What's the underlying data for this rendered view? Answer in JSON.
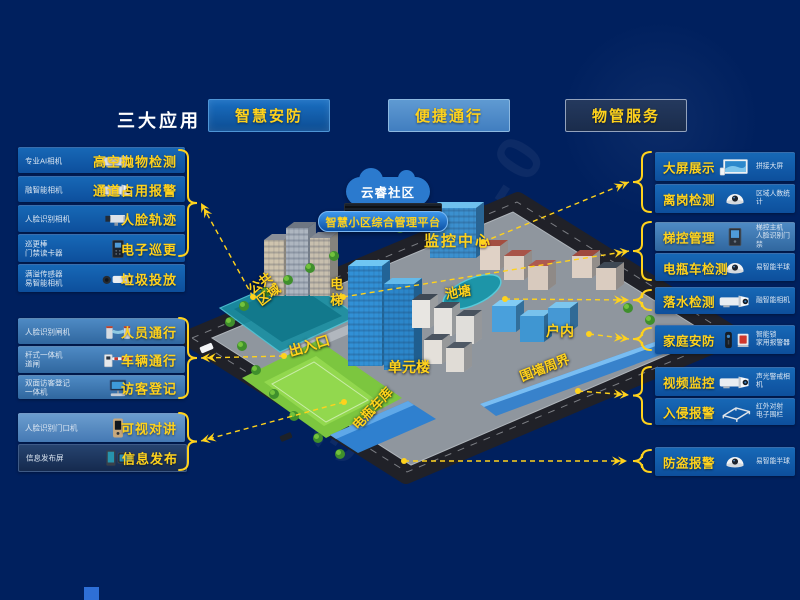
{
  "header": {
    "title": "三大应用",
    "apps": [
      {
        "label": "智慧安防"
      },
      {
        "label": "便捷通行"
      },
      {
        "label": "物管服务"
      }
    ]
  },
  "platform": {
    "cloud_label": "云睿社区",
    "banner": "智慧小区综合管理平台",
    "monitor_center": "监控中心"
  },
  "left_groups": [
    {
      "items": [
        {
          "device": "专业AI相机",
          "label": "高空抛物检测",
          "icon": "bullet-camera-icon"
        },
        {
          "device": "融智能相机",
          "label": "通道占用报警",
          "icon": "bullet-camera-icon"
        },
        {
          "device": "人脸识别相机",
          "label": "人脸轨迹",
          "icon": "box-camera-icon"
        },
        {
          "device": "巡更棒\n门禁读卡器",
          "label": "电子巡更",
          "icon": "access-reader-icon"
        },
        {
          "device": "满溢传感器\n易智能相机",
          "label": "垃圾投放",
          "icon": "sensor-camera-icon"
        }
      ]
    },
    {
      "items": [
        {
          "device": "人脸识别闸机",
          "label": "人员通行",
          "icon": "turnstile-icon"
        },
        {
          "device": "杆式一体机\n道闸",
          "label": "车辆通行",
          "icon": "barrier-gate-icon"
        },
        {
          "device": "双面访客登记\n一体机",
          "label": "访客登记",
          "icon": "visitor-kiosk-icon"
        }
      ]
    },
    {
      "items": [
        {
          "device": "人脸识别门口机",
          "label": "可视对讲",
          "icon": "door-station-icon"
        },
        {
          "device": "信息发布屏",
          "label": "信息发布",
          "icon": "info-screens-icon"
        }
      ]
    }
  ],
  "right_groups": [
    {
      "items": [
        {
          "label": "大屏展示",
          "device": "拼接大屏",
          "icon": "video-wall-icon"
        },
        {
          "label": "离岗检测",
          "device": "区域人数统计",
          "icon": "dome-camera-icon"
        }
      ]
    },
    {
      "items": [
        {
          "label": "梯控管理",
          "device": "梯控主机\n人脸识别门禁",
          "icon": "elevator-panel-icon"
        },
        {
          "label": "电瓶车检测",
          "device": "易智能半球",
          "icon": "dome-camera-icon"
        }
      ]
    },
    {
      "items": [
        {
          "label": "落水检测",
          "device": "融智能相机",
          "icon": "bullet-camera-icon"
        }
      ]
    },
    {
      "items": [
        {
          "label": "家庭安防",
          "device": "智能锁\n家用报警器",
          "icon": "lock-siren-icon"
        }
      ]
    },
    {
      "items": [
        {
          "label": "视频监控",
          "device": "声光警戒相机",
          "icon": "bullet-camera-icon"
        },
        {
          "label": "入侵报警",
          "device": "红外对射\n电子围栏",
          "icon": "fence-icon"
        }
      ]
    },
    {
      "items": [
        {
          "label": "防盗报警",
          "device": "易智能半球",
          "icon": "dome-camera-icon"
        }
      ]
    }
  ],
  "map_labels": [
    {
      "text": "公共\n区域"
    },
    {
      "text": "电梯"
    },
    {
      "text": "池塘"
    },
    {
      "text": "出入口"
    },
    {
      "text": "单元楼"
    },
    {
      "text": "户内"
    },
    {
      "text": "围墙周界"
    },
    {
      "text": "电瓶车库"
    }
  ],
  "watermark": "33-2020-0",
  "colors": {
    "background": "#00205E",
    "accent_yellow": "#FFD21C",
    "bar_blue": "#0F5AA8",
    "bar_light_blue": "#4E8AC4",
    "bar_dark_navy": "#1E3A66",
    "map_highlight_blue": "#2F80CF",
    "pond_teal": "#1D95A8",
    "lawn_green": "#7CC63F"
  }
}
